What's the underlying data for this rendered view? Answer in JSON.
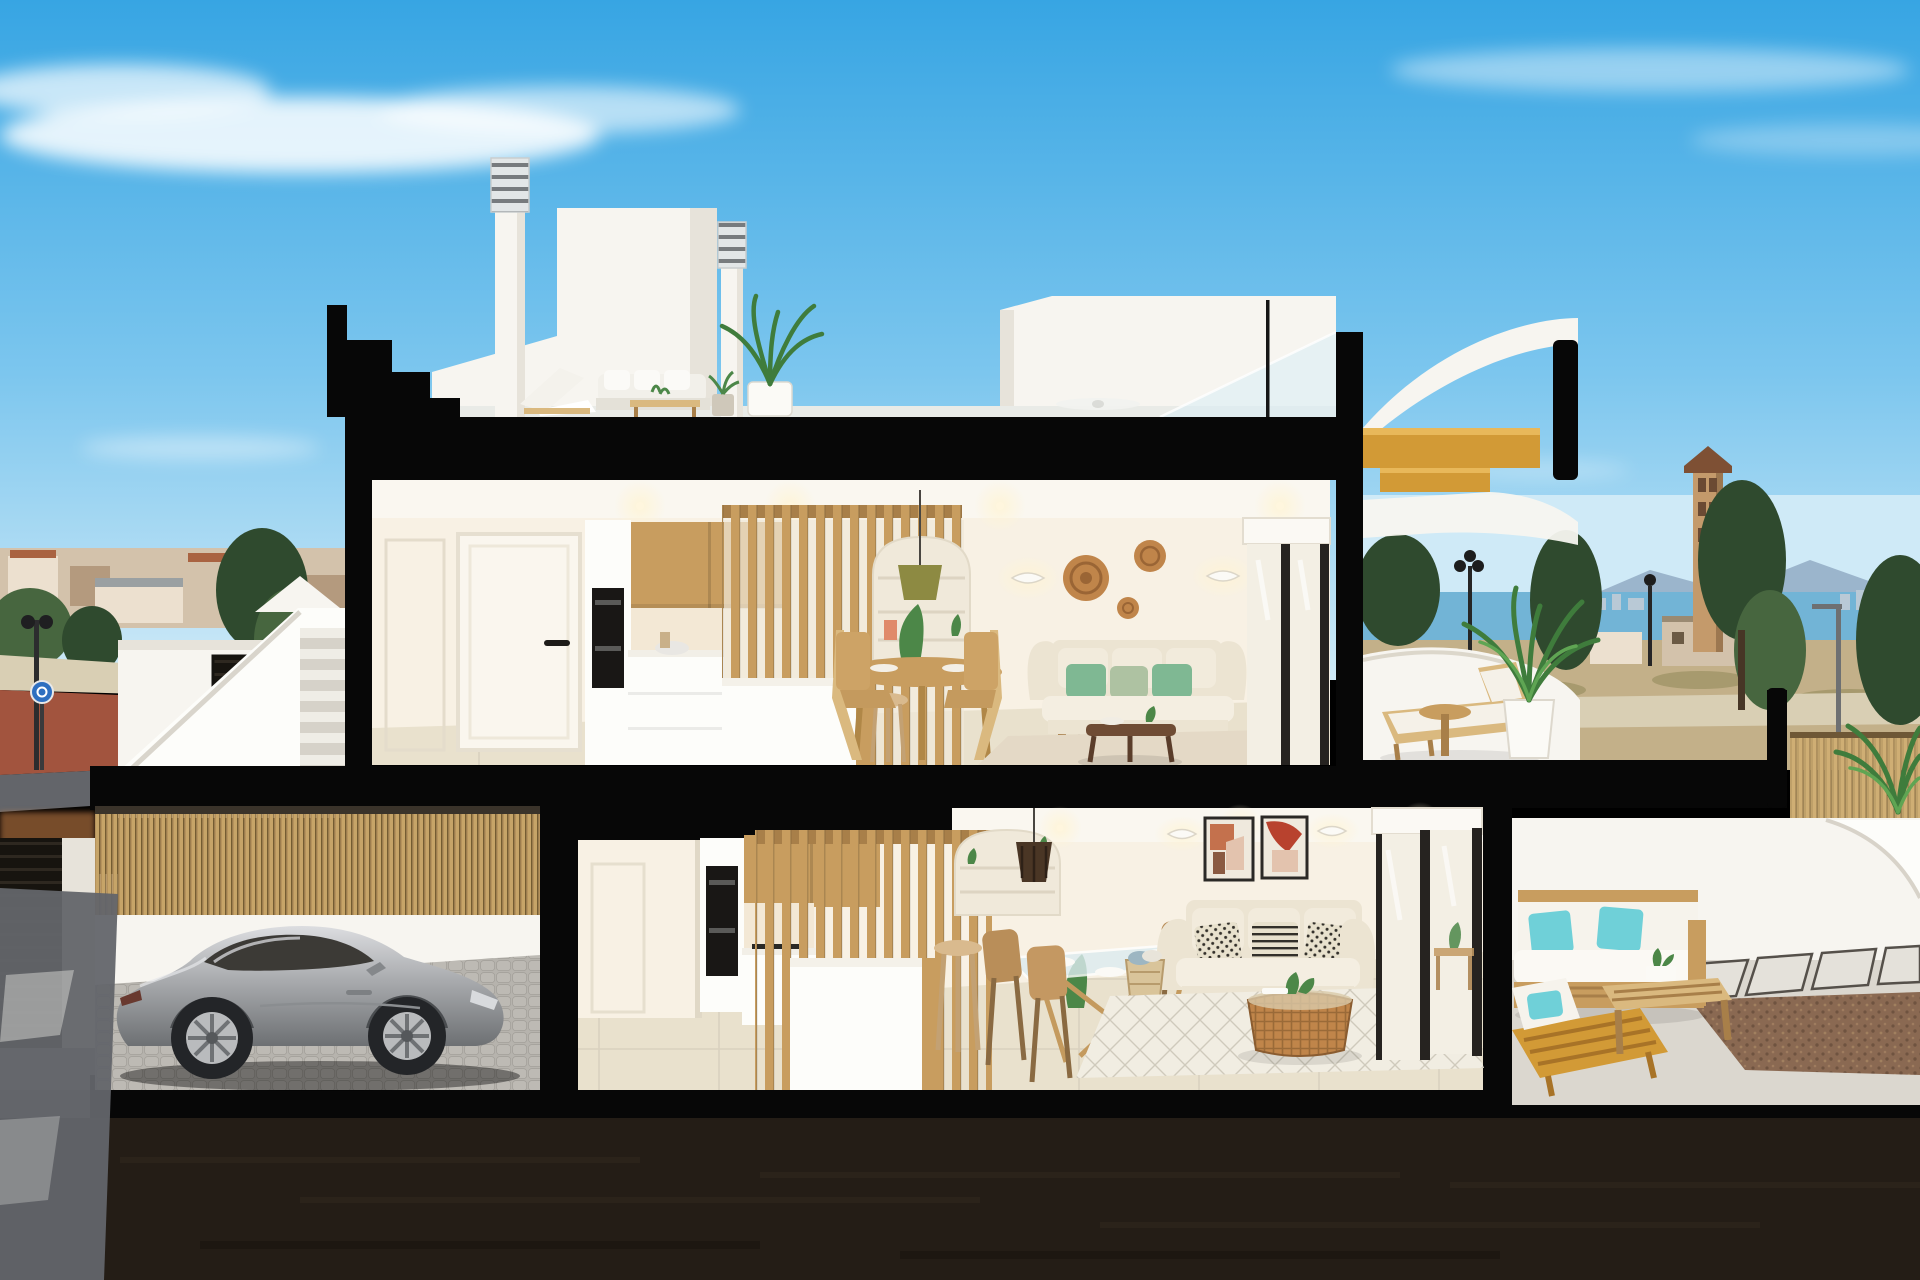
{
  "scene": {
    "description_labels": {},
    "colors": {
      "sky_top": "#37a5e3",
      "sky_mid": "#7cc6ee",
      "sky_horizon": "#cfeaf7",
      "cloud": "#ffffff",
      "sea": "#72b4d6",
      "skyline": "#b9c9d6",
      "mountain": "#8aa3bd",
      "town_base": "#d3c2ab",
      "town_light": "#ece0cf",
      "town_dark": "#b49a7e",
      "roof_terracotta": "#a96341",
      "tree_dark": "#2f4a2e",
      "tree_mid": "#47663f",
      "tree_light": "#6a8a52",
      "field": "#c3b089",
      "scrub": "#a79a6e",
      "back_road": "#d9cfb4",
      "road": "#63656a",
      "road_dark": "#46484c",
      "curb_red": "#b44f3b",
      "curb_white": "#e8e6e1",
      "cut_black": "#070707",
      "wall_white": "#f7f5f0",
      "wall_shade": "#e7e3da",
      "wall_bright": "#fdfdfa",
      "int_wall": "#f8f1e4",
      "int_wall_warm": "#f3e8d5",
      "ceiling": "#faf7f0",
      "wood": "#c89d5f",
      "wood_light": "#dab97f",
      "wood_dark": "#a87f49",
      "stair_gold": "#d29a36",
      "floor_tile": "#e9e1cd",
      "terrace_floor": "#e6e0d1",
      "sofa_cream": "#ece4d2",
      "cushion_green": "#7fb893",
      "cushion_sage": "#aec2a2",
      "cushion_teal": "#6fd0d8",
      "cushion_bw": "#e8e1cd",
      "cushion_dark": "#33302a",
      "rattan": "#c0854a",
      "walnut": "#6f4c34",
      "glass": "#f3efe4",
      "frame_dark": "#262320",
      "car_silver_hi": "#dcdde0",
      "car_silver": "#a9abae",
      "car_silver_lo": "#6d7073",
      "car_glass": "#3c3a36",
      "wheel": "#232528",
      "bamboo": "#c2a268",
      "reed": "#c8ab72",
      "cobble": "#b6b3ad",
      "patio": "#dbd7cf",
      "gravel": "#8a6952",
      "soil": "#241d16",
      "art_terracotta": "#c4714d",
      "art_red": "#b8422e",
      "art_blush": "#e3c3ae",
      "lamp_olive": "#8d8a42",
      "plant_green": "#4c8748",
      "plant_dark": "#356336",
      "sign_blue": "#2e6fc0",
      "tower_tan": "#c49a6b",
      "tower_roof": "#7e5034",
      "glow_warm": "#ffedc9"
    }
  }
}
